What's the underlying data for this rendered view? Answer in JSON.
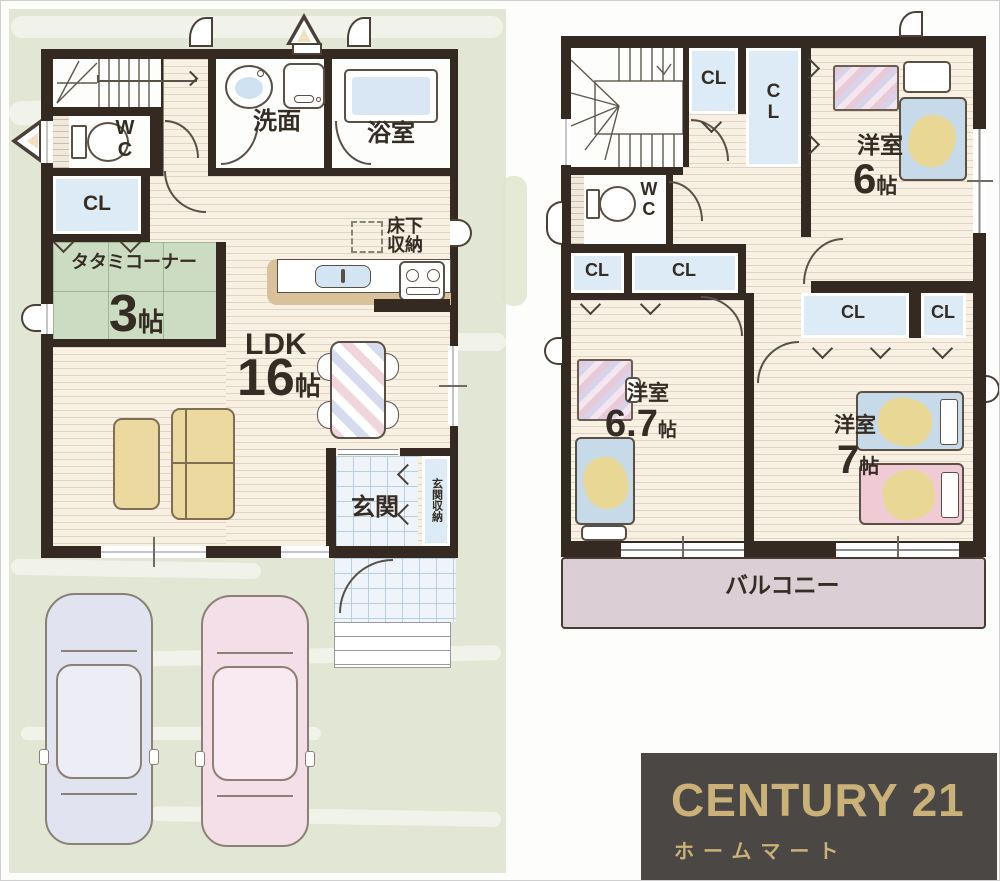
{
  "colors": {
    "wall": "#342a21",
    "wood_floor": "#f7f0e3",
    "tatami_green": "#ccdcc3",
    "closet_blue": "#dcebf5",
    "tile_blue": "#eef4f9",
    "balcony_pink": "#dbced5",
    "panel_green": "#e2e6d4",
    "logo_bg": "#4a4745",
    "logo_gold": "#c9b177"
  },
  "floor1": {
    "wc": {
      "label": "WC"
    },
    "closet": {
      "label": "CL"
    },
    "washroom": {
      "label": "洗面"
    },
    "bath": {
      "label": "浴室"
    },
    "tatami": {
      "name": "タタミコーナー",
      "size": "3",
      "unit": "帖"
    },
    "ldk": {
      "name": "LDK",
      "size": "16",
      "unit": "帖"
    },
    "underfloor": {
      "label": "床下収納"
    },
    "entrance": {
      "label": "玄関"
    },
    "entrance_storage": {
      "label": "玄関収納"
    }
  },
  "floor2": {
    "closet_label": "CL",
    "wc_label": "WC",
    "room6": {
      "name": "洋室",
      "size": "6",
      "unit": "帖"
    },
    "room67": {
      "name": "洋室",
      "size": "6.7",
      "unit": "帖"
    },
    "room7": {
      "name": "洋室",
      "size": "7",
      "unit": "帖"
    },
    "balcony": {
      "label": "バルコニー"
    }
  },
  "logo": {
    "brand": "CENTURY 21",
    "subtitle": "ホームマート"
  }
}
